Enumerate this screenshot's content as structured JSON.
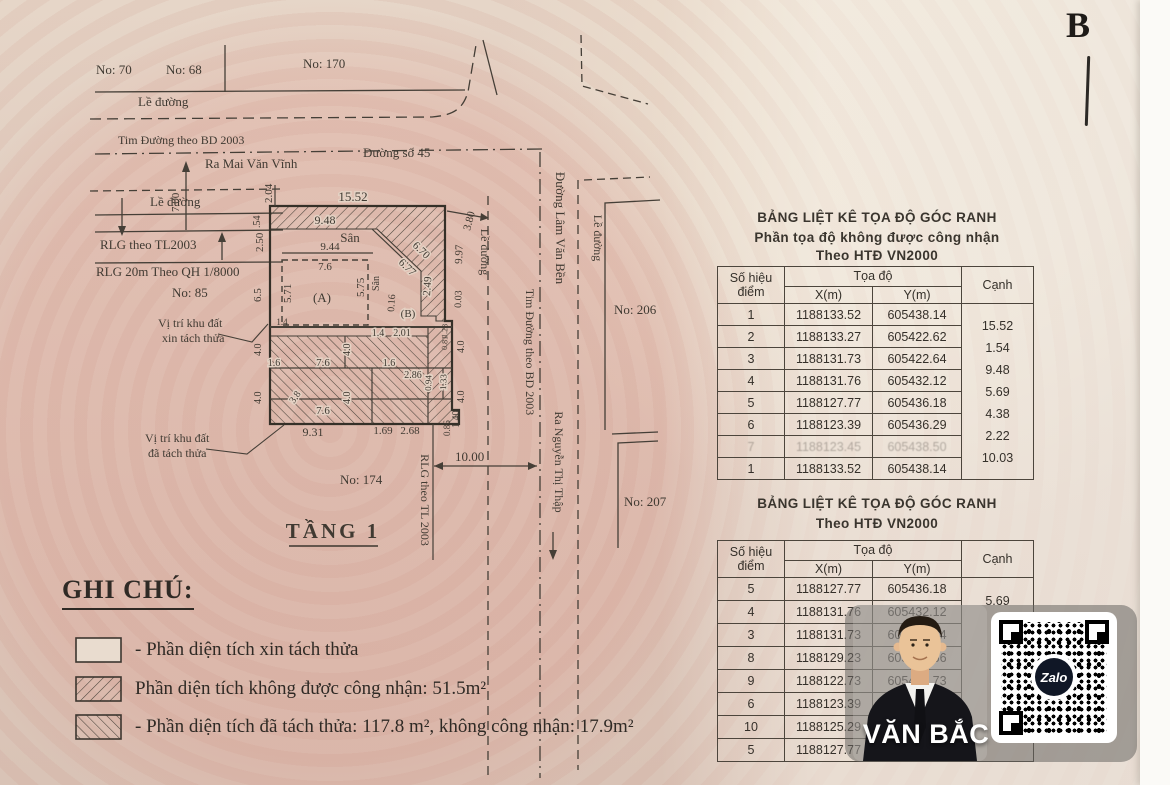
{
  "paper": {
    "corner_letter": "B"
  },
  "drawing": {
    "labels": {
      "no70": "No: 70",
      "no68": "No: 68",
      "no170": "No: 170",
      "no85": "No: 85",
      "no174": "No: 174",
      "no206": "No: 206",
      "no207": "No: 207",
      "le_duong": "Lề đường",
      "tim_duong": "Tim Đường theo BD 2003",
      "ra_mai_van_vinh": "Ra Mai Văn Vĩnh",
      "duong_so_45": "Đường số 45",
      "rlg_tl2003": "RLG theo TL2003",
      "rlg_20m": "RLG 20m Theo QH 1/8000",
      "vi_tri_xin_1": "Vị trí khu đất",
      "vi_tri_xin_2": "xin tách thửa",
      "vi_tri_da_1": "Vị trí khu đất",
      "vi_tri_da_2": "đã tách thửa",
      "san": "Sân",
      "unit_a": "(A)",
      "unit_b": "(B)",
      "duong_lam_van_ben": "Đường Lâm Văn Bền",
      "ra_nguyen_thi_thap": "Ra Nguyễn Thị Thập",
      "rlg_tl_2003_v": "RLG theo TL 2003",
      "tang1": "TẦNG 1"
    },
    "dims": {
      "d1552": "15.52",
      "d948": "9.48",
      "d944": "9.44",
      "d76": "7.6",
      "d204": "2.04",
      "d054": ".54",
      "d250": "2.50",
      "d65": "6.5",
      "d700": "7.00",
      "d380": "3.80",
      "d997": "9.97",
      "d003": "0.03",
      "d670": "6.70",
      "d677": "6.77",
      "d249": "2.49",
      "d571": "5.71",
      "d575": "5.75",
      "d016": "0.16",
      "d14": "1.4",
      "d201": "2.01",
      "d40": "4.0",
      "d16": "1.6",
      "d286": "2.86",
      "d133": "1.33",
      "d094": "0.94",
      "d38": "3.8",
      "d931": "9.31",
      "d169": "1.69",
      "d268": "2.68",
      "d140": "1.40",
      "d086": "0.86",
      "d128": "1.28",
      "d081": "0.81",
      "d1000": "10.00"
    }
  },
  "table1": {
    "title1": "BẢNG LIỆT KÊ TỌA ĐỘ GÓC RANH",
    "title2": "Phần tọa độ không được công nhận",
    "title3": "Theo HTĐ VN2000",
    "col_point_1": "Số hiệu",
    "col_point_2": "điểm",
    "col_coord": "Tọa độ",
    "col_x": "X(m)",
    "col_y": "Y(m)",
    "col_side": "Cạnh",
    "rows": [
      {
        "p": "1",
        "x": "1188133.52",
        "y": "605438.14"
      },
      {
        "p": "2",
        "x": "1188133.27",
        "y": "605422.62"
      },
      {
        "p": "3",
        "x": "1188131.73",
        "y": "605422.64"
      },
      {
        "p": "4",
        "x": "1188131.76",
        "y": "605432.12"
      },
      {
        "p": "5",
        "x": "1188127.77",
        "y": "605436.18"
      },
      {
        "p": "6",
        "x": "1188123.39",
        "y": "605436.29"
      },
      {
        "p": "7",
        "x": "1188123.45",
        "y": "605438.50"
      },
      {
        "p": "1",
        "x": "1188133.52",
        "y": "605438.14"
      }
    ],
    "sides": [
      "15.52",
      "1.54",
      "9.48",
      "5.69",
      "4.38",
      "2.22",
      "10.03"
    ]
  },
  "table2": {
    "title1": "BẢNG LIỆT KÊ TỌA ĐỘ GÓC RANH",
    "title2": "Theo HTĐ VN2000",
    "col_point_1": "Số hiệu",
    "col_point_2": "điểm",
    "col_coord": "Tọa độ",
    "col_x": "X(m)",
    "col_y": "Y(m)",
    "col_side": "Cạnh",
    "rows": [
      {
        "p": "5",
        "x": "1188127.77",
        "y": "605436.18"
      },
      {
        "p": "4",
        "x": "1188131.76",
        "y": "605432.12"
      },
      {
        "p": "3",
        "x": "1188131.73",
        "y": "605422.64"
      },
      {
        "p": "8",
        "x": "1188129.23",
        "y": "605422.66"
      },
      {
        "p": "9",
        "x": "1188122.73",
        "y": "605426.73"
      },
      {
        "p": "6",
        "x": "1188123.39",
        "y": "605436.29"
      },
      {
        "p": "10",
        "x": "1188125.29",
        "y": "605436.21"
      },
      {
        "p": "5",
        "x": "1188127.77",
        "y": "605436.18"
      }
    ],
    "sides": [
      "5.69",
      "",
      "",
      "",
      "",
      "",
      ""
    ]
  },
  "legend": {
    "title": "GHI CHÚ:",
    "item1": "- Phần diện tích xin tách thửa",
    "item2": "Phần diện tích không được công nhận: 51.5m²",
    "item3": "- Phần diện tích đã tách thửa: 117.8 m², không công nhận: 17.9m²"
  },
  "overlay": {
    "name": "VĂN BẮC",
    "qr_brand": "Zalo"
  }
}
